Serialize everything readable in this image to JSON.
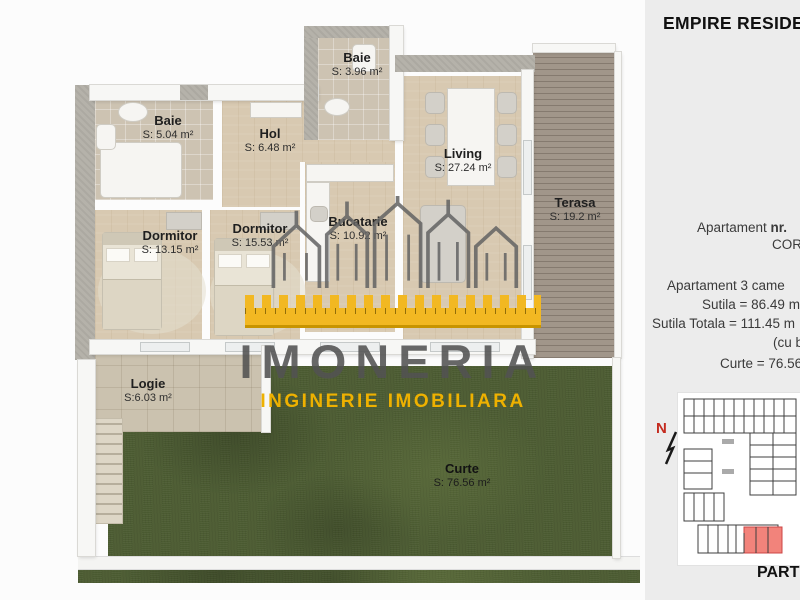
{
  "header": {
    "title": "EMPIRE RESIDENC"
  },
  "info_panel": {
    "apartment_line": {
      "prefix": "Apartament ",
      "bold": "nr."
    },
    "corp_line": "CORP",
    "line_rooms": "Apartament 3 came",
    "line_sutila": "Sutila = 86.49 m",
    "line_sutila_totala": "Sutila Totala = 111.45 m",
    "line_balcon": "(cu balco",
    "line_curte": "Curte = 76.56 m",
    "floor_label": "PARTE",
    "north_label": "N"
  },
  "floor_plan": {
    "rooms": [
      {
        "id": "baie-1",
        "name": "Baie",
        "area": "S: 5.04 m²"
      },
      {
        "id": "baie-2",
        "name": "Baie",
        "area": "S: 3.96 m²"
      },
      {
        "id": "hol",
        "name": "Hol",
        "area": "S: 6.48 m²"
      },
      {
        "id": "living",
        "name": "Living",
        "area": "S: 27.24 m²"
      },
      {
        "id": "terasa",
        "name": "Terasa",
        "area": "S: 19.2 m²"
      },
      {
        "id": "dormitor-1",
        "name": "Dormitor",
        "area": "S: 13.15 m²"
      },
      {
        "id": "dormitor-2",
        "name": "Dormitor",
        "area": "S: 15.53 m²"
      },
      {
        "id": "bucatarie",
        "name": "Bucatarie",
        "area": "S: 10.92 m²"
      },
      {
        "id": "logie",
        "name": "Logie",
        "area": "S:6.03 m²"
      },
      {
        "id": "curte",
        "name": "Curte",
        "area": "S: 76.56 m²"
      }
    ]
  },
  "watermark": {
    "brand": "IMONERIA",
    "tagline": "INGINERIE IMOBILIARA"
  },
  "colors": {
    "accent_yellow": "#f2b822",
    "highlight_red": "#f2837b",
    "grass_green": "#4c5c32",
    "wood_floor": "#d8c9b1",
    "sidebar_bg": "#ececec"
  }
}
